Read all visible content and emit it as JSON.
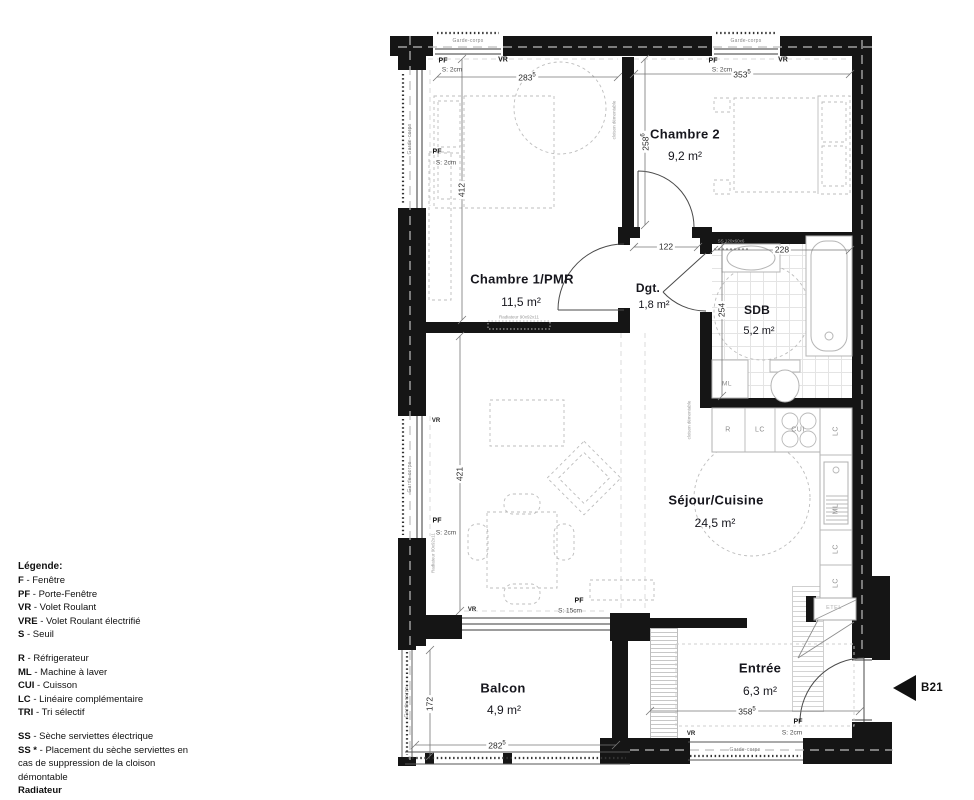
{
  "unit_label": "B21",
  "legend": {
    "title": "Légende:",
    "items1": [
      {
        "abbr": "F",
        "label": "- Fenêtre"
      },
      {
        "abbr": "PF",
        "label": "- Porte-Fenêtre"
      },
      {
        "abbr": "VR",
        "label": "- Volet Roulant"
      },
      {
        "abbr": "VRE",
        "label": "- Volet Roulant électrifié"
      },
      {
        "abbr": "S",
        "label": "- Seuil"
      }
    ],
    "items2": [
      {
        "abbr": "R",
        "label": "- Réfrigerateur"
      },
      {
        "abbr": "ML",
        "label": "- Machine à laver"
      },
      {
        "abbr": "CUI",
        "label": "- Cuisson"
      },
      {
        "abbr": "LC",
        "label": "- Linéaire complémentaire"
      },
      {
        "abbr": "TRI",
        "label": "- Tri sélectif"
      }
    ],
    "items3": [
      {
        "abbr": "SS",
        "label": "- Sèche serviettes électrique"
      },
      {
        "abbr": "SS *",
        "label": "- Placement du sèche serviettes en cas de suppression de la cloison démontable"
      }
    ],
    "footer": "Radiateur"
  },
  "rooms": {
    "chambre2": {
      "name": "Chambre 2",
      "area": "9,2 m²"
    },
    "chambre1": {
      "name": "Chambre 1/PMR",
      "area": "11,5 m²"
    },
    "dgt": {
      "name": "Dgt.",
      "area": "1,8 m²"
    },
    "sdb": {
      "name": "SDB",
      "area": "5,2 m²"
    },
    "sejour": {
      "name": "Séjour/Cuisine",
      "area": "24,5 m²"
    },
    "balcon": {
      "name": "Balcon",
      "area": "4,9 m²"
    },
    "entree": {
      "name": "Entrée",
      "area": "6,3 m²"
    }
  },
  "dims": {
    "d283": {
      "num": "283",
      "sup": "5"
    },
    "d353": {
      "num": "353",
      "sup": "5"
    },
    "d412": {
      "num": "412"
    },
    "d258": {
      "num": "258",
      "sup": "6"
    },
    "d122": {
      "num": "122"
    },
    "d228": {
      "num": "228"
    },
    "d254": {
      "num": "254"
    },
    "d421": {
      "num": "421"
    },
    "d172": {
      "num": "172"
    },
    "d282": {
      "num": "282",
      "sup": "5"
    },
    "d358": {
      "num": "358",
      "sup": "5"
    }
  },
  "openings": {
    "pf": "PF",
    "vr": "VR",
    "s2": "S: 2cm",
    "s15": "S: 15cm"
  },
  "kitchen": {
    "r": "R",
    "lc": "LC",
    "cui": "CUI",
    "ml": "ML",
    "etel": "ETEL"
  },
  "annotations": {
    "garde": "Garde-corps",
    "radiateur": "Radiateur 90x92x11",
    "cloison": "cloison démontable",
    "ss": "SS 120x60x6",
    "ml": "ML"
  }
}
